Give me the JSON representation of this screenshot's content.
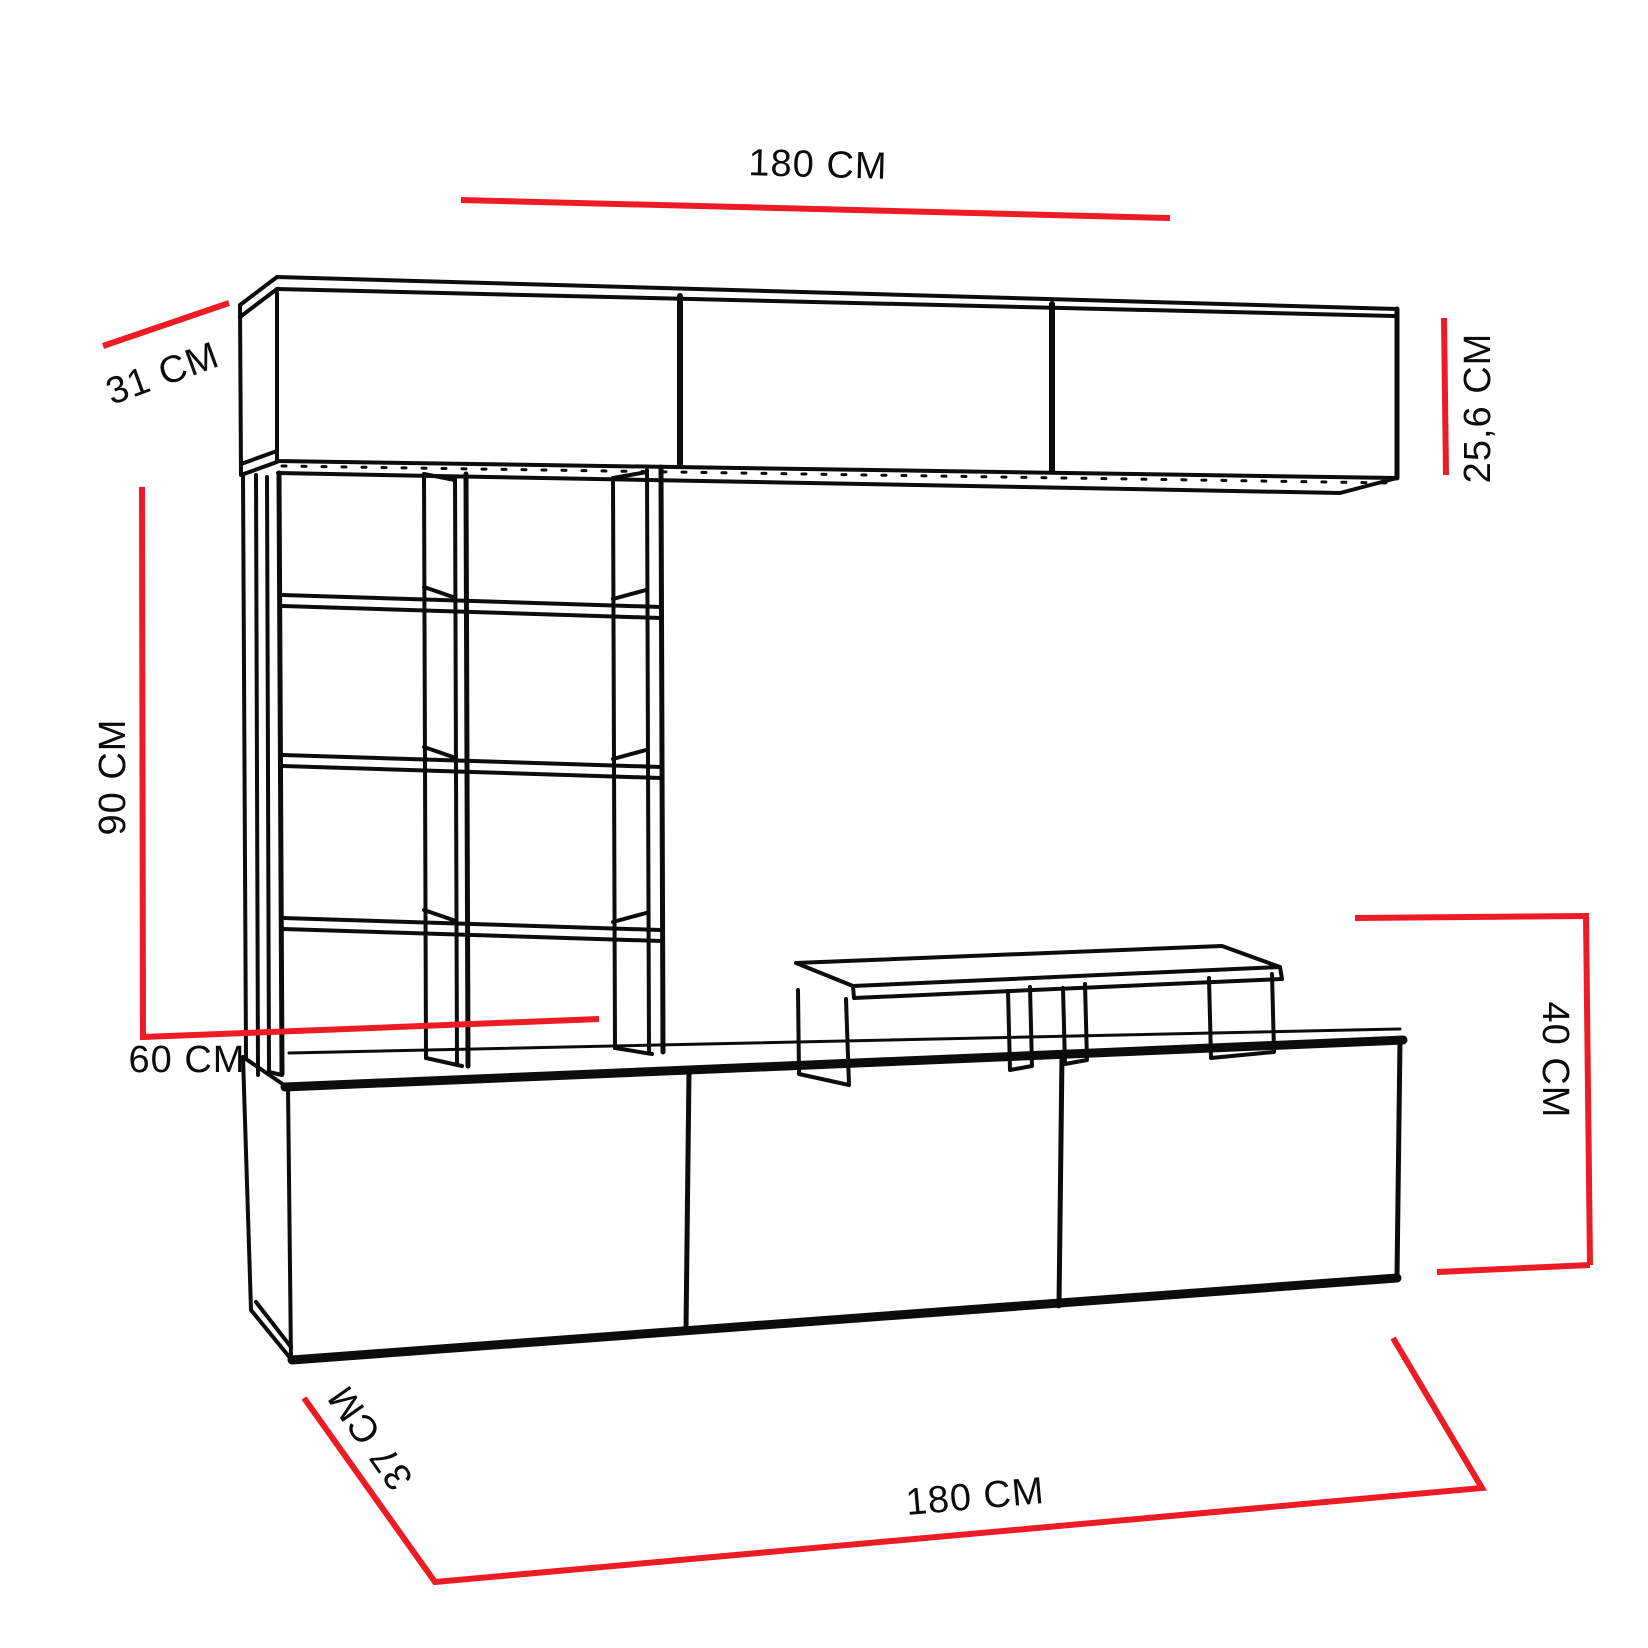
{
  "diagram": {
    "type": "furniture-dimension-drawing",
    "subject": "tv-wall-unit",
    "units": "CM",
    "labels": {
      "top_cabinet_width": "180 CM",
      "top_cabinet_depth": "31 CM",
      "top_cabinet_height": "25,6 CM",
      "shelf_column_height": "90 CM",
      "shelf_column_width": "60 CM",
      "base_cabinet_height": "40 CM",
      "base_cabinet_depth": "37 CM",
      "base_cabinet_width": "180 CM"
    },
    "colors": {
      "dimension_line": "#ed1c24",
      "drawing_line": "#0c0c0c",
      "background": "#ffffff"
    }
  }
}
